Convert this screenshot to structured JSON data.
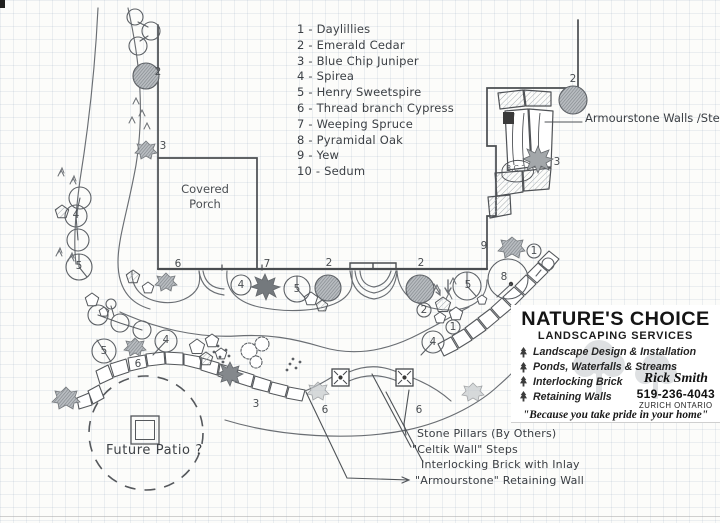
{
  "legend": {
    "items": [
      "1 - Daylillies",
      "2 - Emerald Cedar",
      "3 - Blue Chip Juniper",
      "4 - Spirea",
      "5 - Henry Sweetspire",
      "6 - Thread branch Cypress",
      "7 - Weeping Spruce",
      "8 - Pyramidal Oak",
      "9 - Yew",
      "10 - Sedum"
    ]
  },
  "labels": {
    "covered_porch_line1": "Covered",
    "covered_porch_line2": "Porch",
    "armourstone_walls": "Armourstone Walls /Steps",
    "future_patio": "Future Patio ?",
    "bc3": "B.C.3"
  },
  "annotations": [
    {
      "text": "Stone Pillars (By Others)",
      "x": 417,
      "y": 427
    },
    {
      "text": "\"Celtik Wall\" Steps",
      "x": 412,
      "y": 443
    },
    {
      "text": "Interlocking Brick with Inlay",
      "x": 421,
      "y": 458
    },
    {
      "text": "\"Armourstone\" Retaining Wall",
      "x": 415,
      "y": 474
    }
  ],
  "markers": [
    {
      "label": "2",
      "x": 158,
      "y": 72
    },
    {
      "label": "3",
      "x": 163,
      "y": 146
    },
    {
      "label": "4",
      "x": 76,
      "y": 215
    },
    {
      "label": "5",
      "x": 79,
      "y": 266
    },
    {
      "label": "6",
      "x": 178,
      "y": 264
    },
    {
      "label": "7",
      "x": 267,
      "y": 264
    },
    {
      "label": "4",
      "x": 241,
      "y": 285
    },
    {
      "label": "5",
      "x": 297,
      "y": 289
    },
    {
      "label": "2",
      "x": 329,
      "y": 263
    },
    {
      "label": "2",
      "x": 421,
      "y": 263
    },
    {
      "label": "5",
      "x": 468,
      "y": 285
    },
    {
      "label": "2",
      "x": 424,
      "y": 310
    },
    {
      "label": "9",
      "x": 484,
      "y": 246
    },
    {
      "label": "8",
      "x": 504,
      "y": 277
    },
    {
      "label": "1",
      "x": 534,
      "y": 251
    },
    {
      "label": "1",
      "x": 453,
      "y": 327
    },
    {
      "label": "4",
      "x": 433,
      "y": 342
    },
    {
      "label": "2",
      "x": 573,
      "y": 79
    },
    {
      "label": "3",
      "x": 557,
      "y": 162
    },
    {
      "label": "5",
      "x": 104,
      "y": 351
    },
    {
      "label": "4",
      "x": 166,
      "y": 340
    },
    {
      "label": "6",
      "x": 138,
      "y": 364
    },
    {
      "label": "3",
      "x": 256,
      "y": 404
    },
    {
      "label": "6",
      "x": 325,
      "y": 410
    },
    {
      "label": "6",
      "x": 419,
      "y": 410
    }
  ],
  "card": {
    "title": "NATURE'S CHOICE",
    "subtitle": "LANDSCAPING SERVICES",
    "services": [
      "Landscape Design & Installation",
      "Ponds, Waterfalls & Streams",
      "Interlocking Brick",
      "Retaining Walls"
    ],
    "contact": {
      "name": "Rick Smith",
      "phone": "519-236-4043",
      "city": "ZURICH ONTARIO"
    },
    "tagline": "\"Because you take pride in your home\""
  },
  "colors": {
    "pencil": "#5c6065",
    "wall_ink": "#4a4d50",
    "shading": "#8a8f93",
    "grid": "#d9e2ec"
  }
}
